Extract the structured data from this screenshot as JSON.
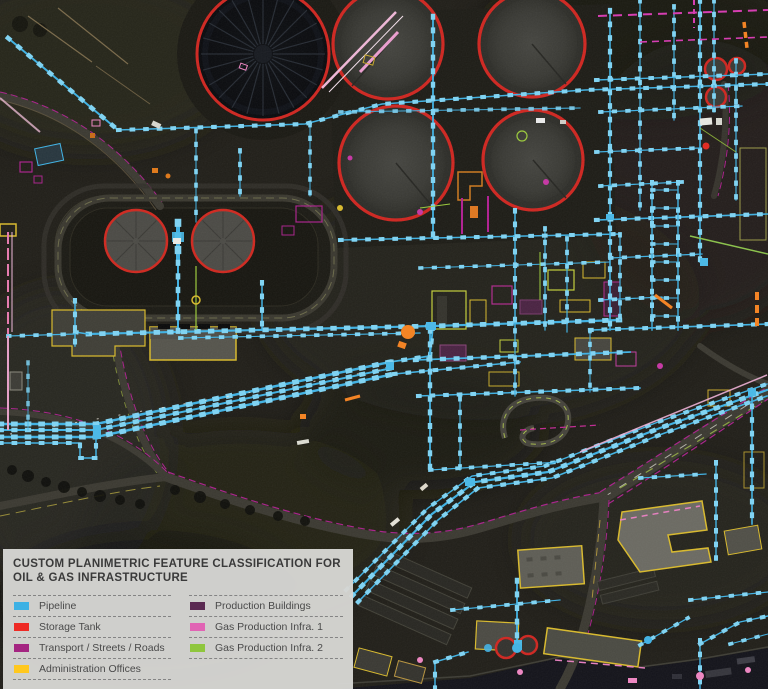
{
  "legend": {
    "title_line1": "CUSTOM PLANIMETRIC FEATURE CLASSIFICATION FOR",
    "title_line2": "OIL & GAS INFRASTRUCTURE",
    "items": [
      {
        "label": "Pipeline",
        "color": "#3db1e4"
      },
      {
        "label": "Storage Tank",
        "color": "#ee2a24"
      },
      {
        "label": "Transport / Streets / Roads",
        "color": "#a42581"
      },
      {
        "label": "Administration Offices",
        "color": "#ffc81e"
      },
      {
        "label": "Production Buildings",
        "color": "#5b2a52"
      },
      {
        "label": "Gas Production Infra. 1",
        "color": "#e164b4"
      },
      {
        "label": "Gas Production Infra. 2",
        "color": "#8fc63d"
      }
    ]
  }
}
